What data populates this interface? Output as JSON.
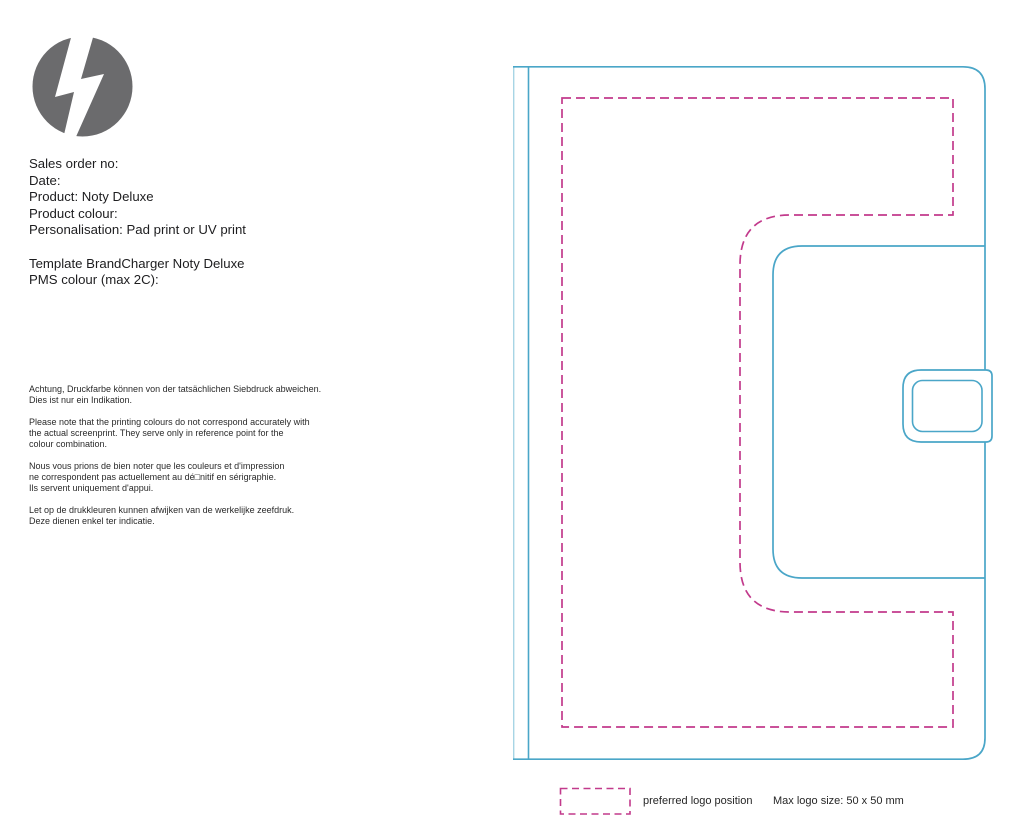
{
  "logo": {
    "icon": "lightning-bolt-icon",
    "circle_color": "#6b6b6d",
    "bolt_color": "#ffffff"
  },
  "order_info": {
    "lines": [
      "Sales order no:",
      "Date:",
      "Product: Noty Deluxe",
      "Product colour:",
      "Personalisation: Pad print or UV print",
      "",
      "Template BrandCharger Noty Deluxe",
      "PMS colour (max 2C):"
    ]
  },
  "disclaimers": {
    "paragraphs": [
      "Achtung, Druckfarbe können von der tatsächlichen Siebdruck abweichen.\nDies ist nur ein Indikation.",
      "Please note that the printing colours do not correspond accurately with\nthe actual screenprint. They serve only in reference point for the\ncolour combination.",
      "Nous vous prions de bien noter que les couleurs et d'impression\nne correspondent pas actuellement au dé□nitif en sérigraphie.\nIls servent uniquement d'appui.",
      "Let op de drukkleuren kunnen afwijken van de werkelijke zeefdruk.\nDeze dienen enkel ter indicatie."
    ]
  },
  "drawing": {
    "subject": "Noty Deluxe notebook back cover with closure flap and clasp",
    "outline_color": "#4aa6c8",
    "spine_edge_color": "#a7d5e5",
    "logo_area_color": "#c23a8c"
  },
  "legend": {
    "swatch": "preferred-logo-position-swatch",
    "label": "preferred logo position",
    "max_size": "Max logo size: 50 x 50 mm"
  }
}
